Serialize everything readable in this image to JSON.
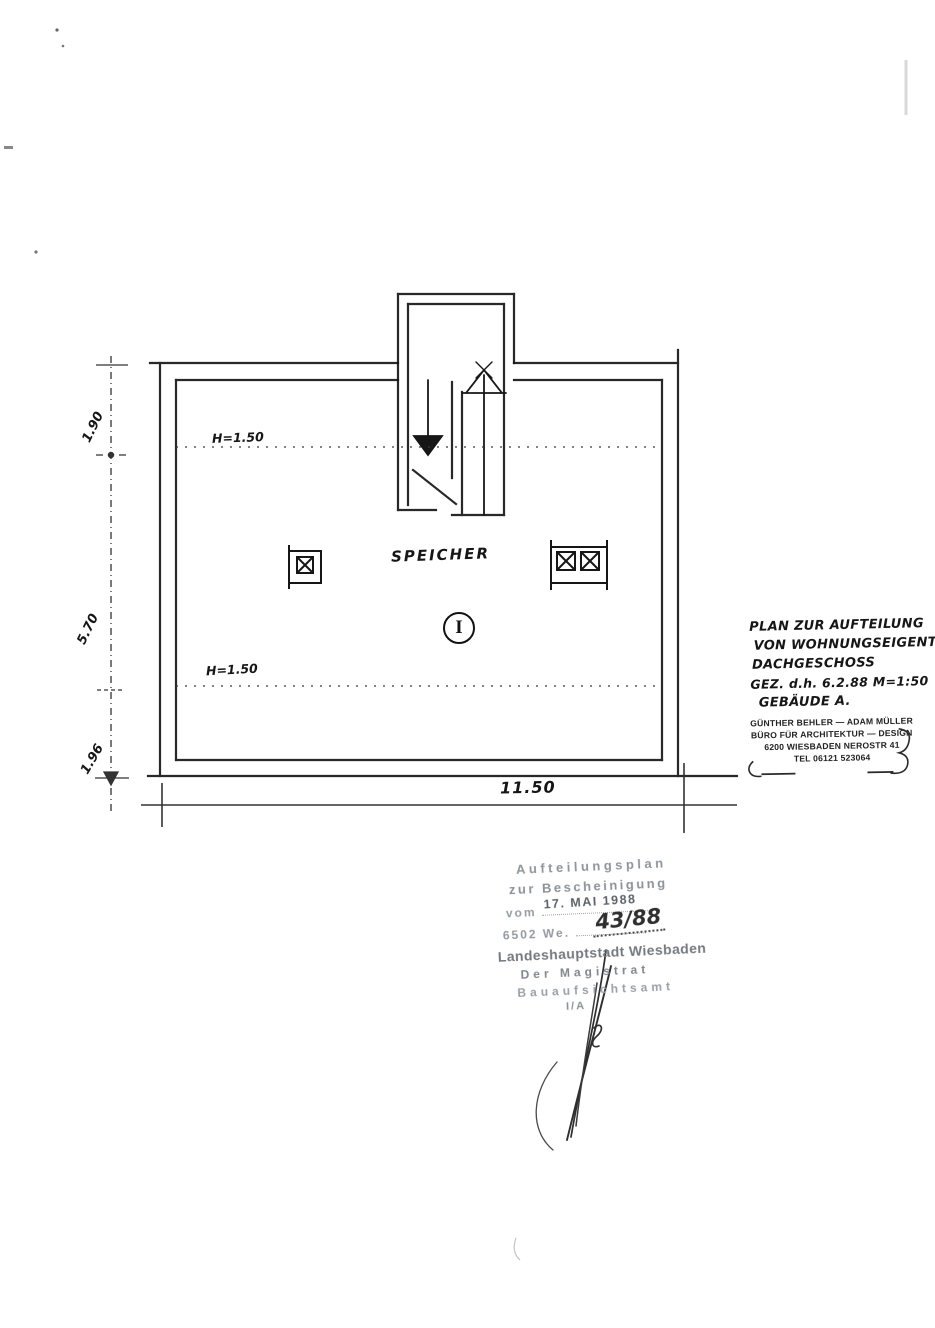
{
  "document": {
    "type": "scanned architectural floor plan",
    "colors": {
      "ink": "#1a1a1a",
      "stamp_gray": "#8d9298",
      "signature_ink": "#2e2e2e"
    }
  },
  "plan": {
    "room_label": "SPEICHER",
    "unit_marker": "I",
    "height_label_top": "H=1.50",
    "height_label_bottom": "H=1.50",
    "dim_left_top": "1.90",
    "dim_left_middle": "5.70",
    "dim_left_bottom": "1.96",
    "dim_bottom": "11.50"
  },
  "annotation": {
    "lines": [
      "PLAN ZUR AUFTEILUNG",
      "VON WOHNUNGSEIGENTUM",
      "DACHGESCHOSS",
      "GEZ. d.h. 6.2.88 M=1:50",
      "GEBÄUDE A."
    ]
  },
  "architect_stamp": {
    "lines": [
      "GÜNTHER BEHLER — ADAM MÜLLER",
      "BÜRO FÜR ARCHITEKTUR — DESIGN",
      "6200 WIESBADEN NEROSTR 41",
      "TEL 06121 523064"
    ]
  },
  "official_stamp": {
    "line1": "Aufteilungsplan",
    "line2": "zur Bescheinigung",
    "line3_prefix": "vom",
    "date": "17. MAI 1988",
    "line4_prefix": "6502 We.",
    "file_number": "43/88",
    "line5": "Landeshauptstadt Wiesbaden",
    "line6": "Der Magistrat",
    "line7": "Bauaufsichtsamt",
    "line8": "I/A"
  }
}
